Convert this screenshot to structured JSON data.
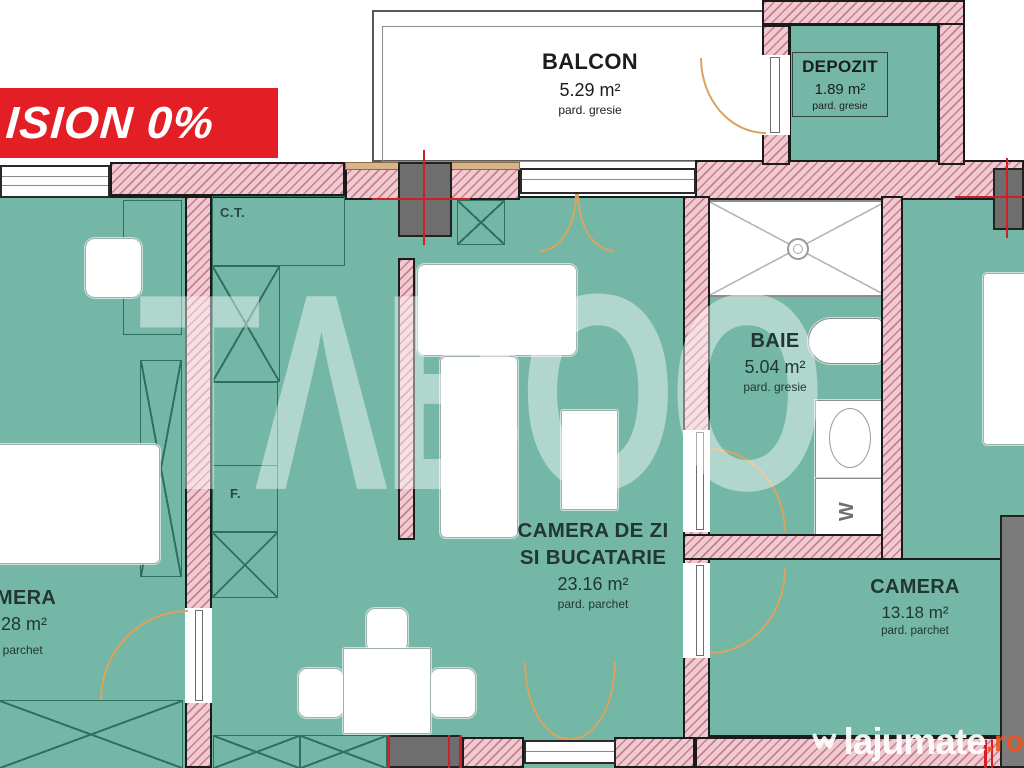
{
  "banner": {
    "text": "ISION 0%"
  },
  "watermark_center": "TΛBOO",
  "watermark_site": {
    "name": "lajumate",
    "tld": ".ro"
  },
  "rooms": {
    "balcon": {
      "name": "BALCON",
      "area": "5.29 m²",
      "floor": "pard. gresie"
    },
    "depozit": {
      "name": "DEPOZIT",
      "area": "1.89 m²",
      "floor": "pard. gresie"
    },
    "baie": {
      "name": "BAIE",
      "area": "5.04 m²",
      "floor": "pard. gresie"
    },
    "living": {
      "name": "CAMERA DE ZI SI BUCATARIE",
      "area": "23.16 m²",
      "floor": "pard. parchet"
    },
    "camera_dreapta": {
      "name": "CAMERA",
      "area": "13.18 m²",
      "floor": "pard. parchet"
    },
    "camera_stanga_partial": {
      "name": "MERA",
      "area": ".28 m²",
      "floor": ". parchet"
    }
  },
  "annotations": {
    "ct": "C.T.",
    "f": "F.",
    "washer": "W"
  },
  "colors": {
    "banner_bg": "#e31e24",
    "room_fill": "#75b7a6",
    "wall_fill": "#eecad1",
    "accent_red": "#cf2027",
    "door_arc": "#d9a45d",
    "tld_orange": "#f0541e"
  }
}
